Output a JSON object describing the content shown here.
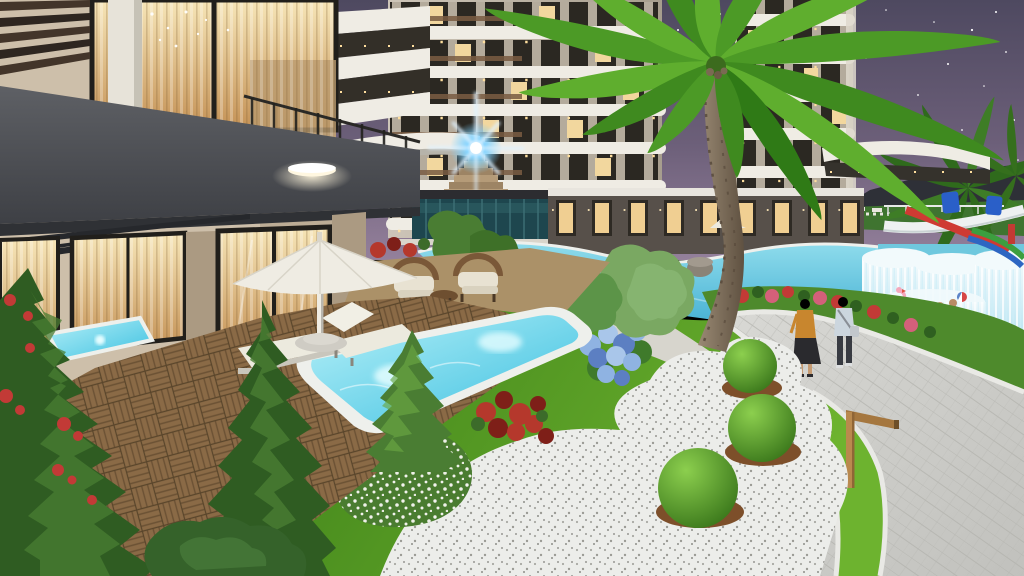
{
  "scene": {
    "title": "Residential resort complex courtyard at dusk — 3D architectural rendering",
    "time_of_day": "dusk, starry purple sky",
    "objects": [
      "foreground apartment building with dark gray balcony and warm lit floor-to-ceiling windows",
      "wood pergola slats over upper window",
      "two background apartment towers with curved white balcony bands and downlights",
      "stepped pyramid water feature with bright blue lens-flare light",
      "teal glass pavilion",
      "large lagoon swimming pool",
      "infinity waterfall wall into lower pool",
      "aquapark slides: red, white tube, green and blue",
      "private plunge pool with underwater lights",
      "small jacuzzi pool by window",
      "white patio umbrella with two sun loungers",
      "rattan seating set with cream cushions",
      "wooden parquet deck",
      "lawn garden with three topiary balls on mulch in white pebble bed",
      "blue hydrangea bush, red coleus plants, white flowering shrub",
      "pine trees and conifers",
      "large coconut palm tree",
      "curved gray paver walkway with white curbs",
      "wooden L-shaped bollard lamp",
      "pink flamingo pool float and beach ball",
      "hedge and brown tiled roof at right"
    ],
    "people": [
      "woman in mustard top and long black skirt walking on path",
      "man in light shirt with shoulder bag walking beside her",
      "two children swimming in the lower pool near a beach ball"
    ]
  },
  "palette": {
    "sky_top": "#4e4960",
    "sky_mid": "#6c5f79",
    "sky_horizon": "#94809b",
    "star": "#ffffff",
    "mountain": "#2e3037",
    "distant_lawn": "#3f7430",
    "tower_wall_light": "#cdc5b8",
    "tower_wall_dark": "#a79e8e",
    "tower_slab": "#efece4",
    "tower_window_dark": "#2b2822",
    "tower_window_lit": "#f2d79e",
    "tower_wood": "#7a5c42",
    "units_wall": "#57504a",
    "units_window": "#f0cf92",
    "units_canopy": "#e8e5de",
    "left_wall_light": "#cdbfaa",
    "left_wall_dark": "#ab9a82",
    "frame_dark": "#211f1b",
    "window_glow_top": "#f7e6b8",
    "window_glow_bottom": "#c49155",
    "fascia_top": "#5e6065",
    "fascia_bottom": "#3e4045",
    "steel": "#26282c",
    "pergola_wood": "#43352a",
    "column_white": "#e7e3d9",
    "deck_wood": "#8a6a46",
    "patio_tile": "#ab9168",
    "umbrella": "#efece3",
    "lounger": "#eceade",
    "rattan": "#7a5838",
    "cushion": "#e8e2d2",
    "small_pool_light": "#b6f0f8",
    "small_pool_deep": "#3cc0e0",
    "coping": "#eef0ec",
    "main_pool_light": "#8fdcec",
    "main_pool_deep": "#2fa3cc",
    "fall_light": "#f2fafc",
    "fall_deep": "#b9e4f2",
    "lawn_light": "#6db32f",
    "lawn_dark": "#478a1d",
    "bank_green": "#4e8a2c",
    "gravel": "#ecedea",
    "mulch": "#7d4f2a",
    "topiary_light": "#8ccf4e",
    "topiary_dark": "#2f6b14",
    "hydrangea1": "#8fb3e2",
    "hydrangea2": "#5c7fc2",
    "hydrangea3": "#a9c6ea",
    "coleus": "#b5382c",
    "coleus_dark": "#7e1f18",
    "pine_dark": "#2f5c22",
    "pine_mid": "#4a7d33",
    "pine_light": "#6aa843",
    "pine_pale": "#7aa862",
    "palm_green1": "#5fae2e",
    "palm_green2": "#4c9a26",
    "palm_green3": "#3f8a1f",
    "palm_trunk_light": "#9a8a74",
    "palm_trunk_dark": "#5f5141",
    "path_gray": "#cbcbc6",
    "curb": "#e9e9e5",
    "slide_red": "#cf3a33",
    "slide_blue": "#2e66c2",
    "slide_green": "#3c9e3f",
    "slide_white": "#eef1f1",
    "pod_blue": "#2a5fc8",
    "flamingo": "#f4a8bc",
    "skin": "#c59a72",
    "p1_top": "#c8862e",
    "p1_skirt": "#2a2a2e",
    "p2_shirt": "#ccd6de",
    "p2_pants": "#383b42",
    "bollard": "#b9894e",
    "hedge": "#2e5a26",
    "roof": "#6e4c34",
    "pavilion_glass": "#1e464e",
    "pyramid": "#b59b78",
    "flare": "#7fd2ff",
    "flower_red": "#c23a36",
    "flower_pink": "#d4607a",
    "flower_white": "#f3f3ee"
  }
}
